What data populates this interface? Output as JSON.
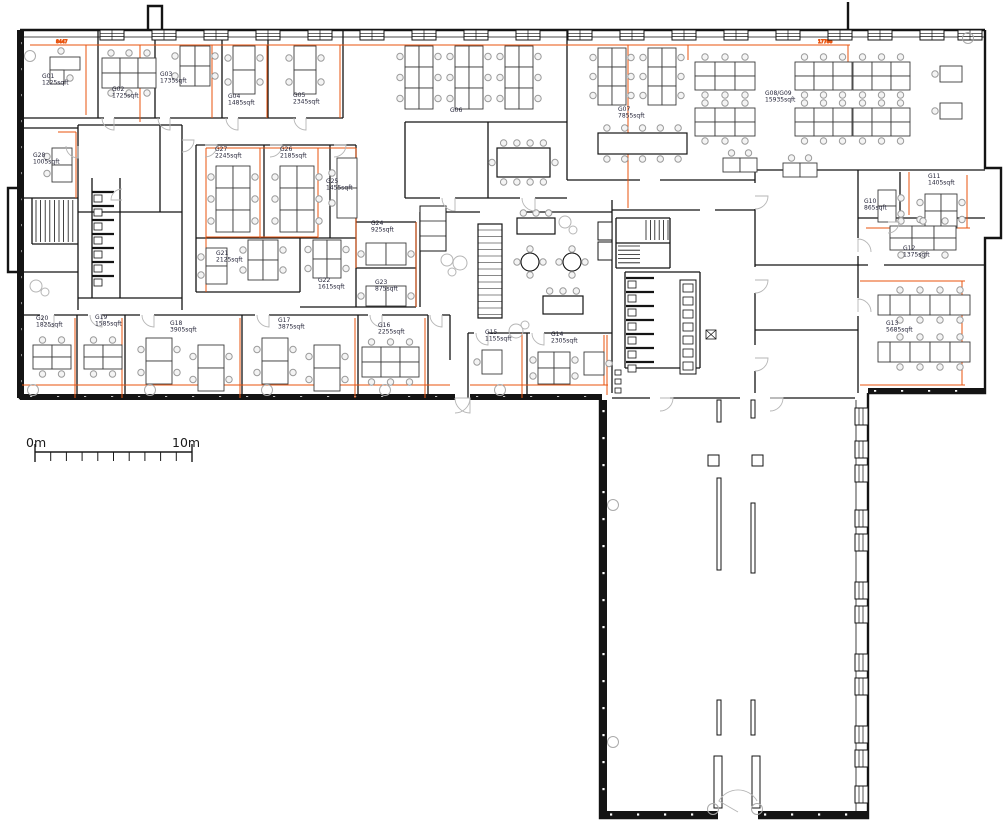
{
  "rooms": [
    {
      "id": "G01",
      "area": "1225sqft"
    },
    {
      "id": "G02",
      "area": "1725sqft"
    },
    {
      "id": "G03",
      "area": "1735sqft"
    },
    {
      "id": "G04",
      "area": "1485sqft"
    },
    {
      "id": "G05",
      "area": "2345sqft"
    },
    {
      "id": "G06",
      "area": ""
    },
    {
      "id": "G07",
      "area": "7855sqft"
    },
    {
      "id": "G08/G09",
      "area": "15935sqft"
    },
    {
      "id": "G10",
      "area": "865sqft"
    },
    {
      "id": "G11",
      "area": "1405sqft"
    },
    {
      "id": "G12",
      "area": "1375sqft"
    },
    {
      "id": "G13",
      "area": "5685sqft"
    },
    {
      "id": "G14",
      "area": "2305sqft"
    },
    {
      "id": "G15",
      "area": "1155sqft"
    },
    {
      "id": "G16",
      "area": "2255sqft"
    },
    {
      "id": "G17",
      "area": "3875sqft"
    },
    {
      "id": "G18",
      "area": "3905sqft"
    },
    {
      "id": "G19",
      "area": "1585sqft"
    },
    {
      "id": "G20",
      "area": "1825sqft"
    },
    {
      "id": "G21",
      "area": "2125sqft"
    },
    {
      "id": "G22",
      "area": "1615sqft"
    },
    {
      "id": "G23",
      "area": "875sqft"
    },
    {
      "id": "G24",
      "area": "925sqft"
    },
    {
      "id": "G25",
      "area": "1455sqft"
    },
    {
      "id": "G26",
      "area": "2185sqft"
    },
    {
      "id": "G27",
      "area": "2245sqft"
    },
    {
      "id": "G28",
      "area": "1005sqft"
    }
  ],
  "scale_bar": {
    "start": "0m",
    "end": "10m"
  },
  "dimension_labels": [
    {
      "text": "8447"
    },
    {
      "text": "17786"
    }
  ],
  "colors": {
    "wall": "#141414",
    "demise_line": "#e8530e",
    "desk_outline": "#3c3c3c",
    "chair": "#9b9b9b",
    "door_arc": "#b5b5b5",
    "label_text": "#26263a"
  }
}
